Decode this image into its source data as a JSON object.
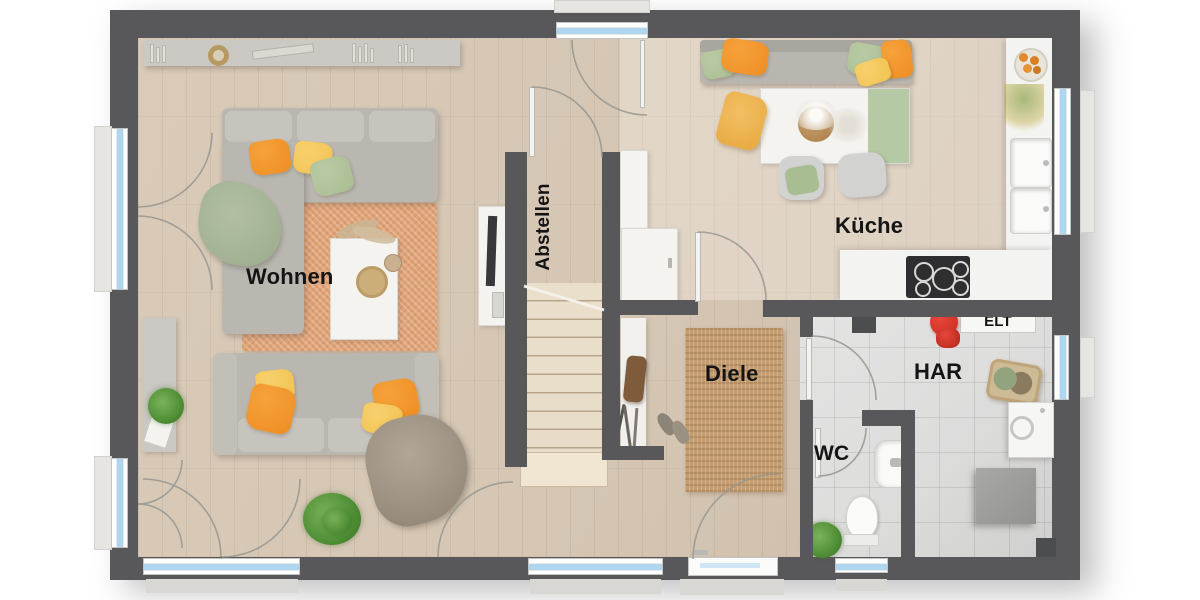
{
  "rooms": {
    "wohnen": {
      "label": "Wohnen"
    },
    "abstellen": {
      "label": "Abstellen"
    },
    "kueche": {
      "label": "Küche"
    },
    "diele": {
      "label": "Diele"
    },
    "har": {
      "label": "HAR"
    },
    "elt": {
      "label": "ELT"
    },
    "wc": {
      "label": "WC"
    }
  },
  "colors": {
    "wall": "#58585a",
    "floor-wood": "#d5c6b4",
    "floor-tile": "#dcdcdb",
    "stairs": "#e7dcc8",
    "rug-living": "#e0a377",
    "rug-jute": "#c49c6e",
    "sofa": "#bab7b1",
    "pillow-orange": "#ee8d22",
    "pillow-yellow": "#f2c24f",
    "pillow-green": "#a9bd92",
    "counter": "#f3f3f1",
    "cooktop": "#2e2e30",
    "glass": "#aed6ee",
    "accent-red": "#cc2a20",
    "label": "#141414"
  }
}
